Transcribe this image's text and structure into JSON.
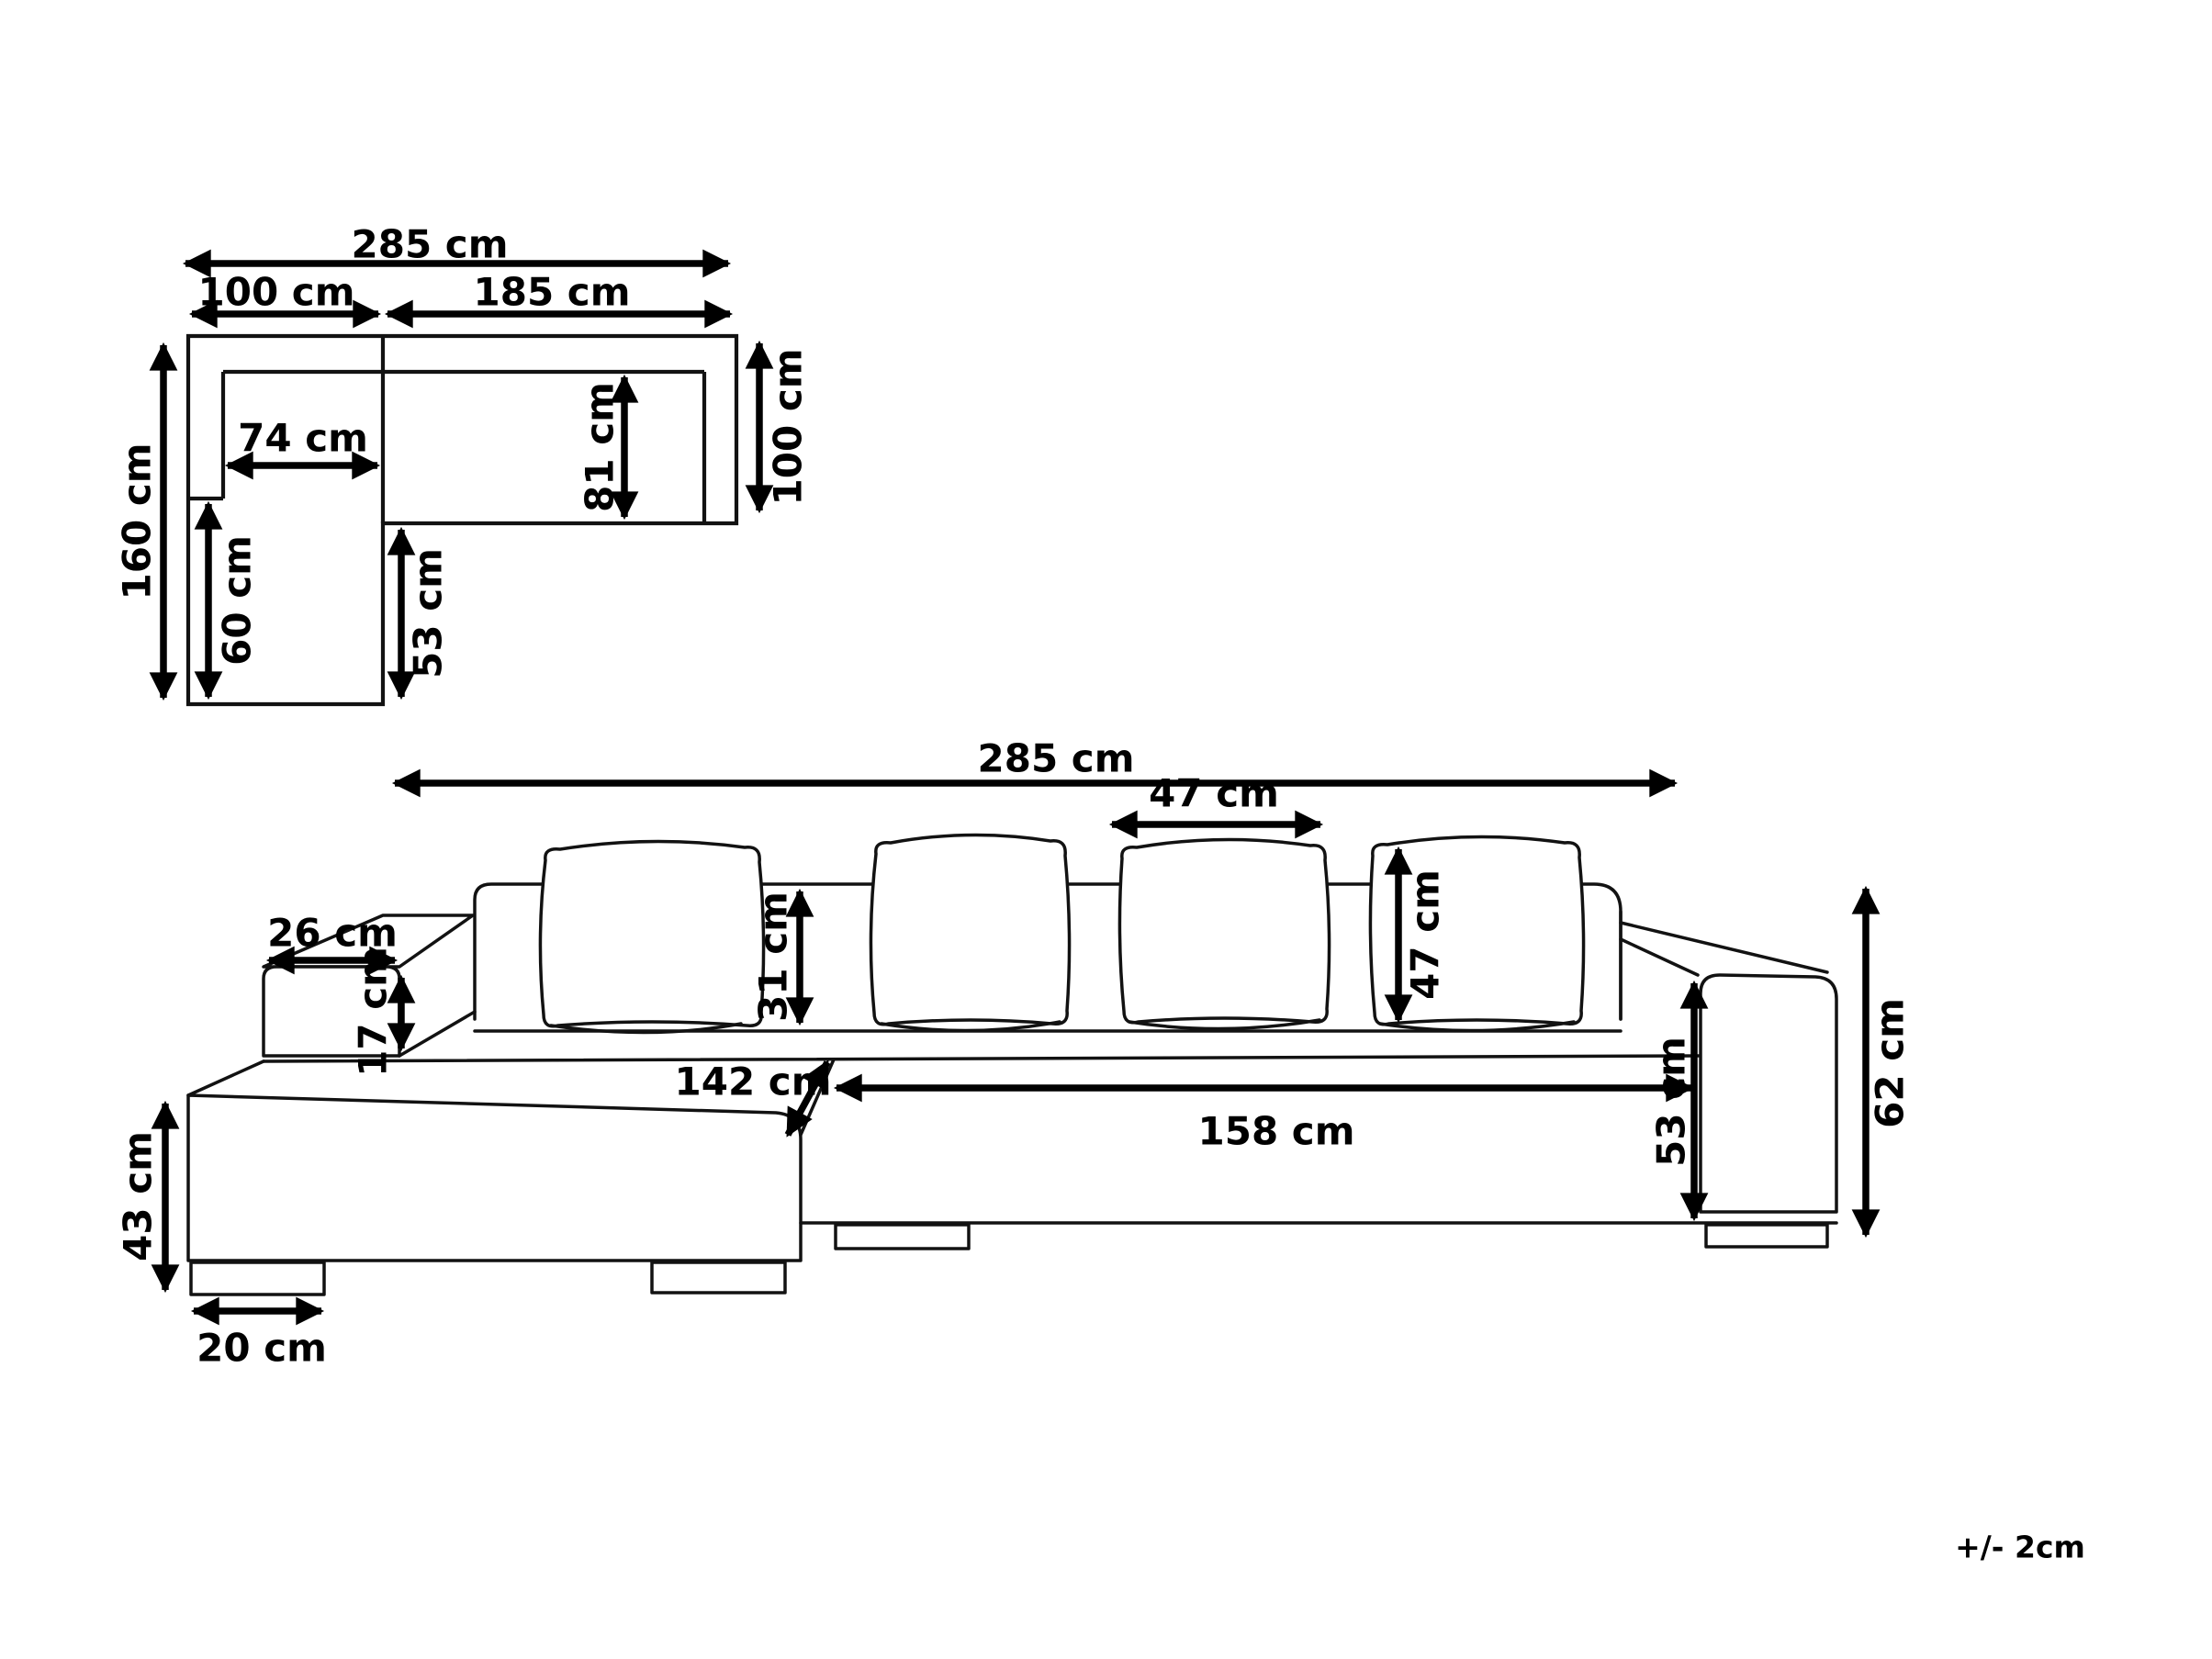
{
  "diagram": {
    "tolerance_note": "+/- 2cm",
    "top_view": {
      "total_width": "285 cm",
      "chaise_section_width": "100 cm",
      "right_section_width": "185 cm",
      "chaise_seat_width": "74 cm",
      "seat_depth": "81 cm",
      "right_section_depth": "100 cm",
      "chaise_section_depth": "160 cm",
      "chaise_front_depth": "60 cm",
      "chaise_overhang_depth": "53 cm"
    },
    "front_view": {
      "total_width": "285 cm",
      "cushion_width": "47 cm",
      "cushion_height": "47 cm",
      "armrest_top_depth": "26 cm",
      "armrest_front_height": "17 cm",
      "backrest_above_seat": "31 cm",
      "chaise_diagonal_length": "142 cm",
      "inner_seat_width": "158 cm",
      "seat_height": "53 cm",
      "armrest_height": "62 cm",
      "chaise_front_height": "43 cm",
      "foot_width": "20 cm"
    }
  }
}
